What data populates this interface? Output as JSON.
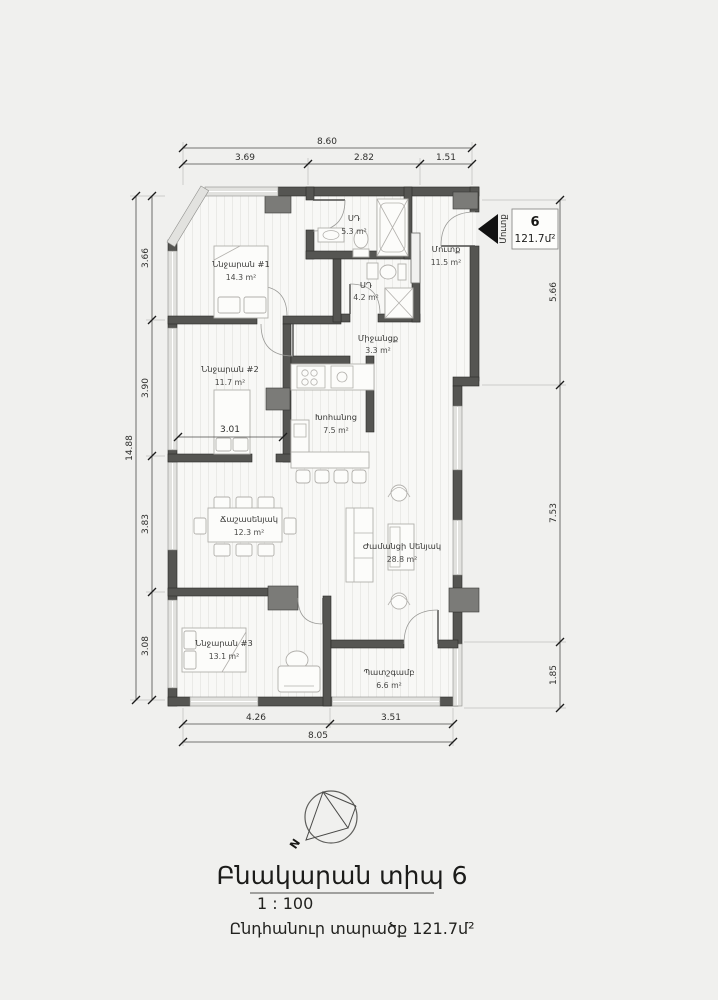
{
  "unit_marker": {
    "number": "6",
    "area": "121.7մ²",
    "entrance_label": "Մուտք"
  },
  "rooms": {
    "bedroom1": {
      "name": "Ննջարան #1",
      "area": "14.3 m²"
    },
    "bath1": {
      "name": "ՍԴ",
      "area": "5.3 m²"
    },
    "bath2": {
      "name": "ՍԴ",
      "area": "4.2 m²"
    },
    "entry": {
      "name": "Մուտք",
      "area": "11.5 m²"
    },
    "corridor": {
      "name": "Միջանցք",
      "area": "3.3 m²"
    },
    "bedroom2": {
      "name": "Ննջարան #2",
      "area": "11.7 m²"
    },
    "kitchen": {
      "name": "Խոհանոց",
      "area": "7.5 m²"
    },
    "dining": {
      "name": "Ճաշասենյակ",
      "area": "12.3 m²"
    },
    "living": {
      "name": "Ժամանցի Սենյակ",
      "area": "28.8 m²"
    },
    "bedroom3": {
      "name": "Ննջարան #3",
      "area": "13.1 m²"
    },
    "balcony": {
      "name": "Պատշգամբ",
      "area": "6.6 m²"
    }
  },
  "dimensions": {
    "top_total": "8.60",
    "top_segments": [
      "3.69",
      "2.82",
      "1.51"
    ],
    "left_total": "14.88",
    "left_segments": [
      "3.66",
      "3.90",
      "3.83",
      "3.08"
    ],
    "right_segments": [
      "5.66",
      "7.53",
      "1.85"
    ],
    "bottom_segments": [
      "4.26",
      "3.51"
    ],
    "bottom_total": "8.05",
    "interior_width": "3.01"
  },
  "compass": {
    "north": "N"
  },
  "title_block": {
    "heading": "Բնակարան տիպ 6",
    "scale": "1 : 100",
    "total_area": "Ընդհանուր տարածք 121.7մ²"
  },
  "colors": {
    "wall": "#555552",
    "background": "#f0f0ee",
    "entrance_arrow": "#111111"
  }
}
